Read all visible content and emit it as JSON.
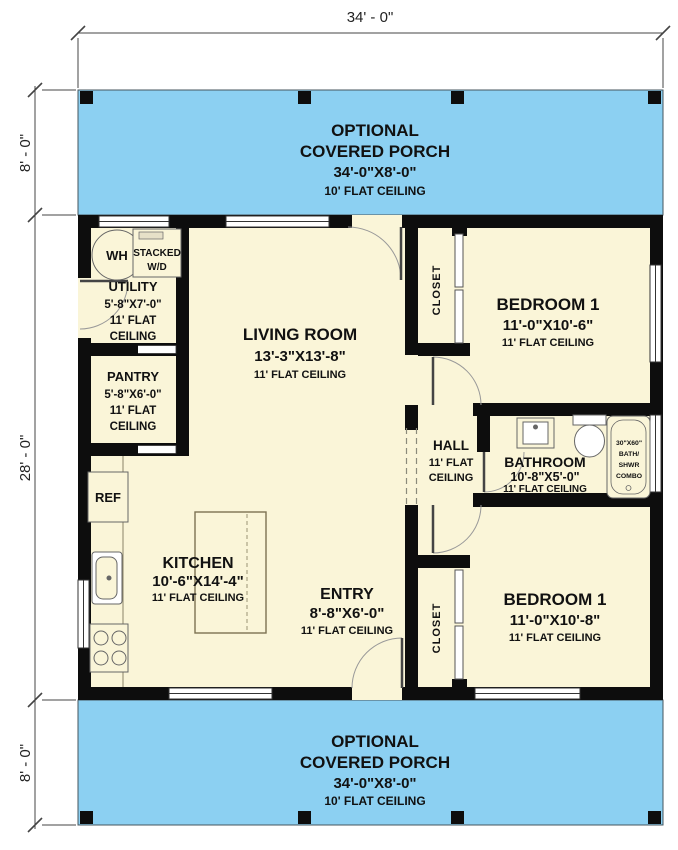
{
  "title": "Floor plan - one story cottage",
  "dims": {
    "top": "34' - 0\"",
    "porch_top": "8' - 0\"",
    "main": "28' - 0\"",
    "porch_bottom": "8' - 0\""
  },
  "porch_top": {
    "l1": "OPTIONAL",
    "l2": "COVERED PORCH",
    "l3": "34'-0\"X8'-0\"",
    "l4": "10' FLAT CEILING"
  },
  "porch_bottom": {
    "l1": "OPTIONAL",
    "l2": "COVERED PORCH",
    "l3": "34'-0\"X8'-0\"",
    "l4": "10' FLAT CEILING"
  },
  "rooms": {
    "utility": {
      "name": "UTILITY",
      "size": "5'-8\"X7'-0\"",
      "c1": "11' FLAT",
      "c2": "CEILING"
    },
    "pantry": {
      "name": "PANTRY",
      "size": "5'-8\"X6'-0\"",
      "c1": "11' FLAT",
      "c2": "CEILING"
    },
    "living": {
      "name": "LIVING ROOM",
      "size": "13'-3\"X13'-8\"",
      "ceiling": "11' FLAT CEILING"
    },
    "kitchen": {
      "name": "KITCHEN",
      "size": "10'-6\"X14'-4\"",
      "ceiling": "11' FLAT CEILING"
    },
    "entry": {
      "name": "ENTRY",
      "size": "8'-8\"X6'-0\"",
      "ceiling": "11' FLAT CEILING"
    },
    "hall": {
      "name": "HALL",
      "c1": "11' FLAT",
      "c2": "CEILING"
    },
    "bathroom": {
      "name": "BATHROOM",
      "size": "10'-8\"X5'-0\"",
      "ceiling": "11' FLAT CEILING"
    },
    "bedroom1": {
      "name": "BEDROOM 1",
      "size": "11'-0\"X10'-6\"",
      "ceiling": "11' FLAT CEILING"
    },
    "bedroom2": {
      "name": "BEDROOM 1",
      "size": "11'-0\"X10'-8\"",
      "ceiling": "11' FLAT CEILING"
    },
    "closet1": "CLOSET",
    "closet2": "CLOSET"
  },
  "fixtures": {
    "water_heater": "WH",
    "wd1": "STACKED",
    "wd2": "W/D",
    "ref": "REF",
    "tub": {
      "l1": "30\"X60\"",
      "l2": "BATH/",
      "l3": "SHWR",
      "l4": "COMBO"
    }
  },
  "colors": {
    "porch": "#8cd0f2",
    "floor": "#faf5d8",
    "wall": "#0d0d0d",
    "line": "#555555"
  }
}
